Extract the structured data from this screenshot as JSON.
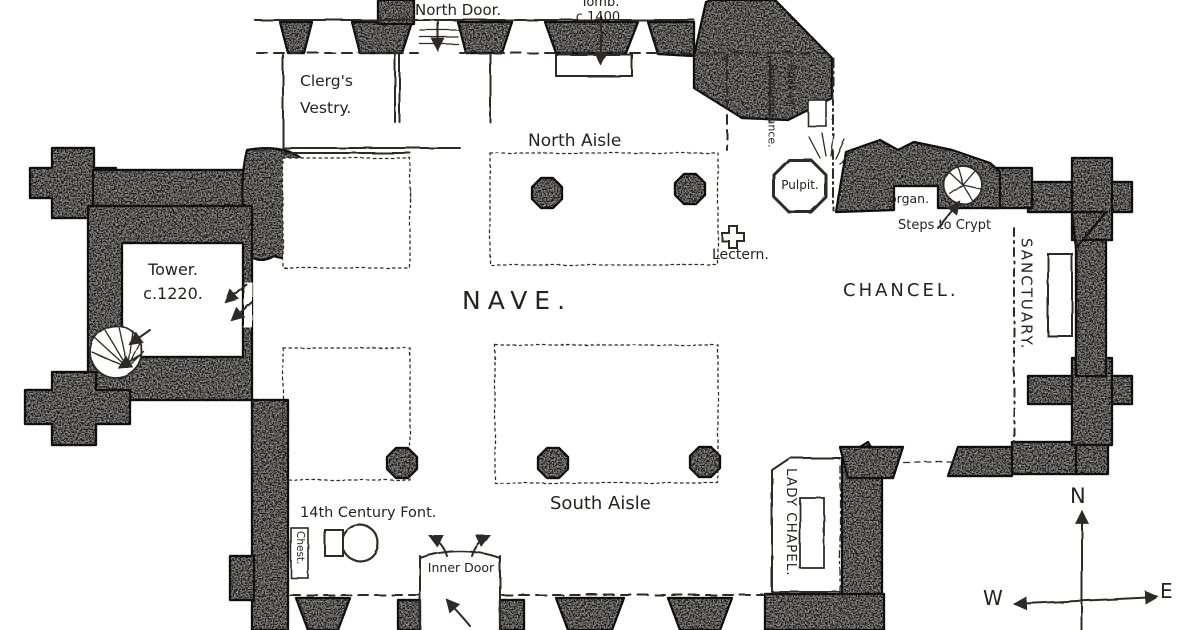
{
  "drawing": {
    "title": "Hand-drawn church floor plan",
    "rooms": {
      "nave": "NAVE.",
      "north_aisle": "North Aisle",
      "south_aisle": "South Aisle",
      "chancel": "CHANCEL.",
      "sanctuary": "SANCTUARY.",
      "lady_chapel": "LADY CHAPEL.",
      "vestry": "Clerg's\nVestry.",
      "tower": "Tower.\nc.1220."
    },
    "features": {
      "north_door": "North Door.",
      "tomb": "Tomb.\nc.1400.",
      "book_of_remembrance": "Book of\nRemembrance.",
      "pulpit": "Pulpit.",
      "lectern": "Lectern.",
      "organ": "organ.",
      "steps_to_crypt": "Steps to Crypt",
      "font": "14th Century Font.",
      "chest": "Chest.",
      "inner_door": "Inner Door"
    },
    "compass": {
      "north": "N",
      "west": "W",
      "east": "E"
    },
    "colors": {
      "paper": "#ffffff",
      "ink": "#2e2a25",
      "wall": "#c8c4bf"
    }
  }
}
